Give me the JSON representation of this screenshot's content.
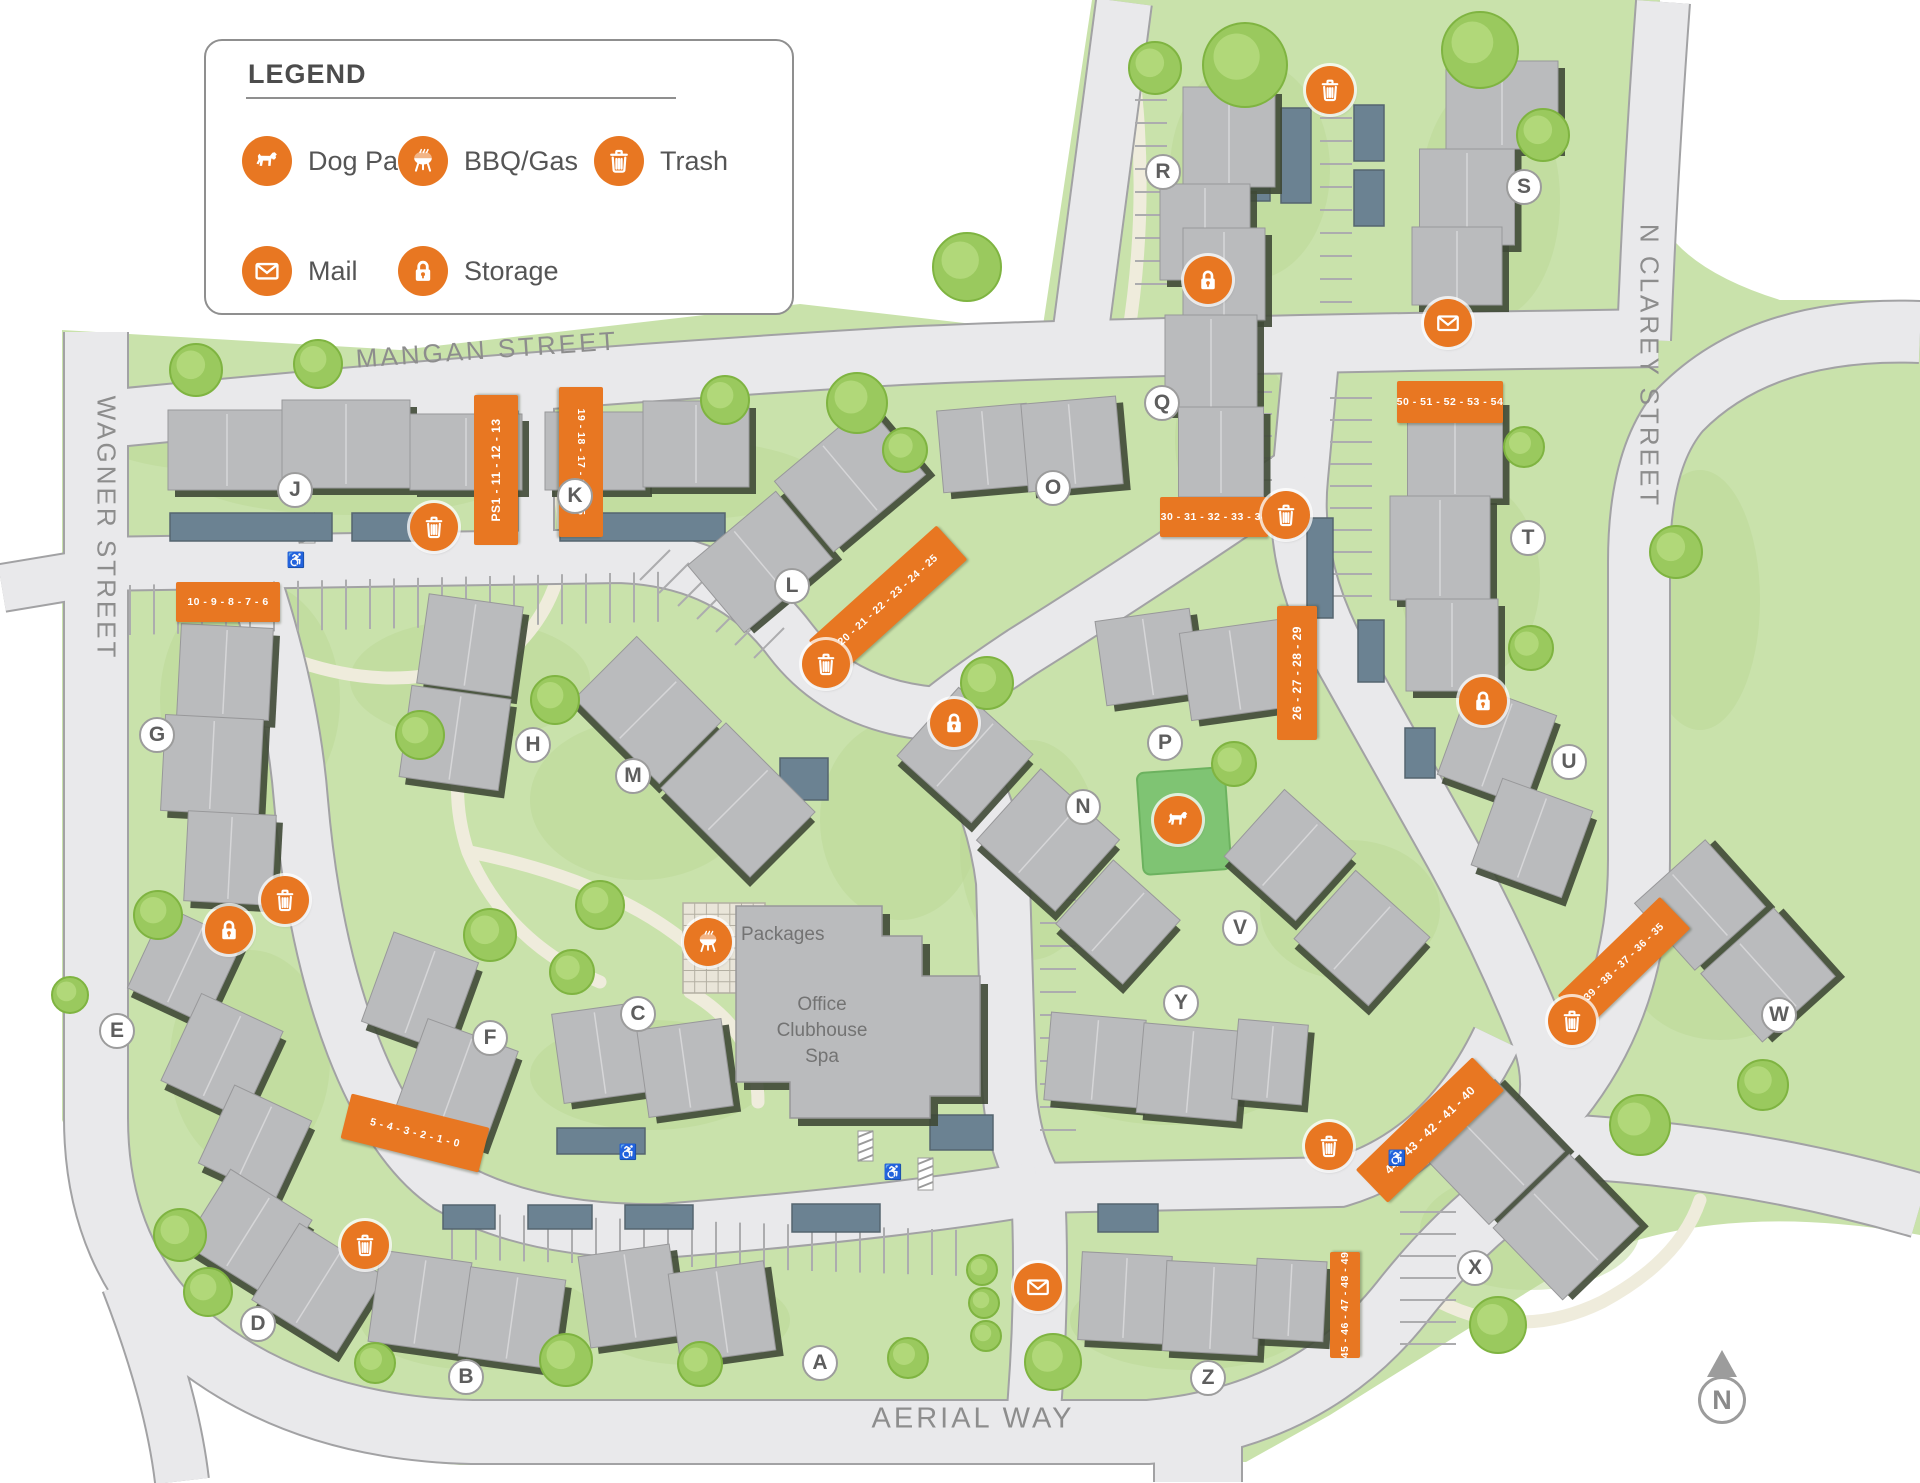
{
  "legend": {
    "title": "LEGEND",
    "items": [
      {
        "icon": "dog",
        "label": "Dog Park"
      },
      {
        "icon": "bbq",
        "label": "BBQ/Gas"
      },
      {
        "icon": "trash",
        "label": "Trash"
      },
      {
        "icon": "mail",
        "label": "Mail"
      },
      {
        "icon": "storage",
        "label": "Storage"
      }
    ]
  },
  "streets": [
    {
      "name": "MANGAN STREET",
      "x": 487,
      "y": 350,
      "rot": -4,
      "size": 26
    },
    {
      "name": "WAGNER STREET",
      "x": 106,
      "y": 528,
      "rot": 90,
      "size": 26
    },
    {
      "name": "N CLAREY STREET",
      "x": 1649,
      "y": 366,
      "rot": 90,
      "size": 26
    },
    {
      "name": "AERIAL WAY",
      "x": 973,
      "y": 1419,
      "rot": 0,
      "size": 29
    }
  ],
  "buildings": [
    {
      "letter": "A",
      "x": 820,
      "y": 1363
    },
    {
      "letter": "B",
      "x": 466,
      "y": 1377
    },
    {
      "letter": "C",
      "x": 638,
      "y": 1014
    },
    {
      "letter": "D",
      "x": 258,
      "y": 1324
    },
    {
      "letter": "E",
      "x": 117,
      "y": 1031
    },
    {
      "letter": "F",
      "x": 490,
      "y": 1038
    },
    {
      "letter": "G",
      "x": 157,
      "y": 735
    },
    {
      "letter": "H",
      "x": 533,
      "y": 745
    },
    {
      "letter": "J",
      "x": 295,
      "y": 490
    },
    {
      "letter": "K",
      "x": 575,
      "y": 496
    },
    {
      "letter": "L",
      "x": 792,
      "y": 586
    },
    {
      "letter": "M",
      "x": 633,
      "y": 776
    },
    {
      "letter": "N",
      "x": 1083,
      "y": 807
    },
    {
      "letter": "O",
      "x": 1053,
      "y": 488
    },
    {
      "letter": "P",
      "x": 1165,
      "y": 743
    },
    {
      "letter": "Q",
      "x": 1162,
      "y": 403
    },
    {
      "letter": "R",
      "x": 1163,
      "y": 172
    },
    {
      "letter": "S",
      "x": 1524,
      "y": 187
    },
    {
      "letter": "T",
      "x": 1528,
      "y": 538
    },
    {
      "letter": "U",
      "x": 1569,
      "y": 762
    },
    {
      "letter": "V",
      "x": 1240,
      "y": 928
    },
    {
      "letter": "W",
      "x": 1779,
      "y": 1015
    },
    {
      "letter": "X",
      "x": 1475,
      "y": 1268
    },
    {
      "letter": "Y",
      "x": 1181,
      "y": 1003
    },
    {
      "letter": "Z",
      "x": 1208,
      "y": 1378
    }
  ],
  "unit_labels": [
    {
      "text": "PS1 - 11 - 12 - 13",
      "x": 496,
      "y": 470,
      "w": 150,
      "h": 44,
      "rot": -90
    },
    {
      "text": "19 - 18 - 17 - 16 - 15",
      "x": 581,
      "y": 462,
      "w": 150,
      "h": 44,
      "rot": 90
    },
    {
      "text": "10 - 9 - 8 - 7 - 6",
      "x": 228,
      "y": 602,
      "w": 104,
      "h": 40,
      "rot": 0
    },
    {
      "text": "50 - 51 - 52 - 53 - 54",
      "x": 1450,
      "y": 402,
      "w": 106,
      "h": 42,
      "rot": 0
    },
    {
      "text": "30 - 31 - 32 - 33 - 34",
      "x": 1214,
      "y": 517,
      "w": 108,
      "h": 40,
      "rot": 0
    },
    {
      "text": "26 - 27 - 28 - 29",
      "x": 1297,
      "y": 673,
      "w": 134,
      "h": 40,
      "rot": -90
    },
    {
      "text": "20 - 21 - 22 - 23 - 24 - 25",
      "x": 888,
      "y": 600,
      "w": 172,
      "h": 46,
      "rot": -42
    },
    {
      "text": "5 - 4 - 3 - 2 - 1 - 0",
      "x": 415,
      "y": 1133,
      "w": 142,
      "h": 46,
      "rot": 14
    },
    {
      "text": "39 - 38 - 37 - 36 - 35",
      "x": 1624,
      "y": 962,
      "w": 142,
      "h": 44,
      "rot": -44
    },
    {
      "text": "44 - 43 - 42 - 41 - 40",
      "x": 1430,
      "y": 1130,
      "w": 162,
      "h": 46,
      "rot": -44
    },
    {
      "text": "45 - 46 - 47 - 48 - 49",
      "x": 1345,
      "y": 1305,
      "w": 106,
      "h": 30,
      "rot": -90
    }
  ],
  "amenities": [
    {
      "type": "trash",
      "x": 1330,
      "y": 90
    },
    {
      "type": "trash",
      "x": 434,
      "y": 527
    },
    {
      "type": "trash",
      "x": 1286,
      "y": 515
    },
    {
      "type": "trash",
      "x": 826,
      "y": 664
    },
    {
      "type": "trash",
      "x": 285,
      "y": 900
    },
    {
      "type": "trash",
      "x": 1572,
      "y": 1021
    },
    {
      "type": "trash",
      "x": 1329,
      "y": 1146
    },
    {
      "type": "trash",
      "x": 365,
      "y": 1245
    },
    {
      "type": "storage",
      "x": 1208,
      "y": 280
    },
    {
      "type": "storage",
      "x": 954,
      "y": 723
    },
    {
      "type": "storage",
      "x": 1483,
      "y": 701
    },
    {
      "type": "storage",
      "x": 229,
      "y": 930
    },
    {
      "type": "mail",
      "x": 1448,
      "y": 323
    },
    {
      "type": "mail",
      "x": 1038,
      "y": 1287
    },
    {
      "type": "dog",
      "x": 1178,
      "y": 820
    },
    {
      "type": "bbq",
      "x": 708,
      "y": 942
    }
  ],
  "facilities": [
    {
      "text": "Packages",
      "x": 741,
      "y": 935,
      "align": "left"
    },
    {
      "text": "Office",
      "x": 822,
      "y": 1005,
      "align": "center"
    },
    {
      "text": "Clubhouse",
      "x": 822,
      "y": 1031,
      "align": "center"
    },
    {
      "text": "Spa",
      "x": 822,
      "y": 1057,
      "align": "center"
    }
  ],
  "compass": {
    "label": "N"
  },
  "colors": {
    "accent_orange": "#E87722",
    "site_green": "#C9E2AB",
    "road_gray": "#E9E9EB",
    "building_gray": "#BABBBD",
    "carport_slate": "#6B8292",
    "shadow_olive": "#3F4936",
    "path_cream": "#EFECDC",
    "dog_park_green": "#7FC473"
  }
}
